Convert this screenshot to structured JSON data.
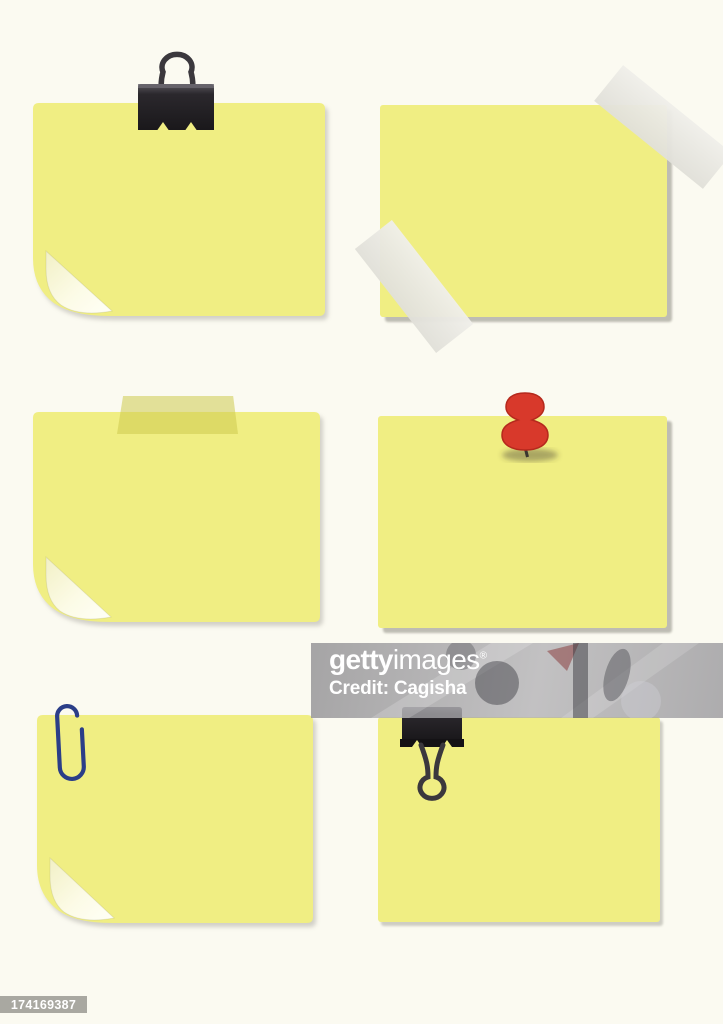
{
  "colors": {
    "page_background": "#FBFAF1",
    "note_yellow": "#F0EE83",
    "curl_light": "#FCFBE6",
    "tape_white": "#E9E8E2",
    "tape_yellow_green": "#DEDC6E",
    "binder_clip_black": "#232025",
    "binder_clip_wire": "#3B383D",
    "paper_clip_blue": "#2B3E88",
    "push_pin_red": "#D8392B",
    "shadow_gray": "#B3B1A7",
    "watermark_gray": "#94939A",
    "watermark_text": "#FFFFFF",
    "id_plate_gray": "#A9A8A1"
  },
  "watermark": {
    "brand_bold": "getty",
    "brand_light": "images",
    "registered": "®",
    "credit_line": "Credit: Cagisha"
  },
  "image_id": "174169387",
  "notes": [
    {
      "position": "top-left",
      "attachment": "binder-clip-upright",
      "corner_curl": true
    },
    {
      "position": "top-right",
      "attachment": "two-white-tape-strips",
      "corner_curl": false
    },
    {
      "position": "middle-left",
      "attachment": "yellow-tape-strip",
      "corner_curl": true
    },
    {
      "position": "middle-right",
      "attachment": "red-push-pin",
      "corner_curl": false
    },
    {
      "position": "bottom-left",
      "attachment": "paper-clip",
      "corner_curl": true
    },
    {
      "position": "bottom-right",
      "attachment": "binder-clip-hanging",
      "corner_curl": false
    }
  ]
}
